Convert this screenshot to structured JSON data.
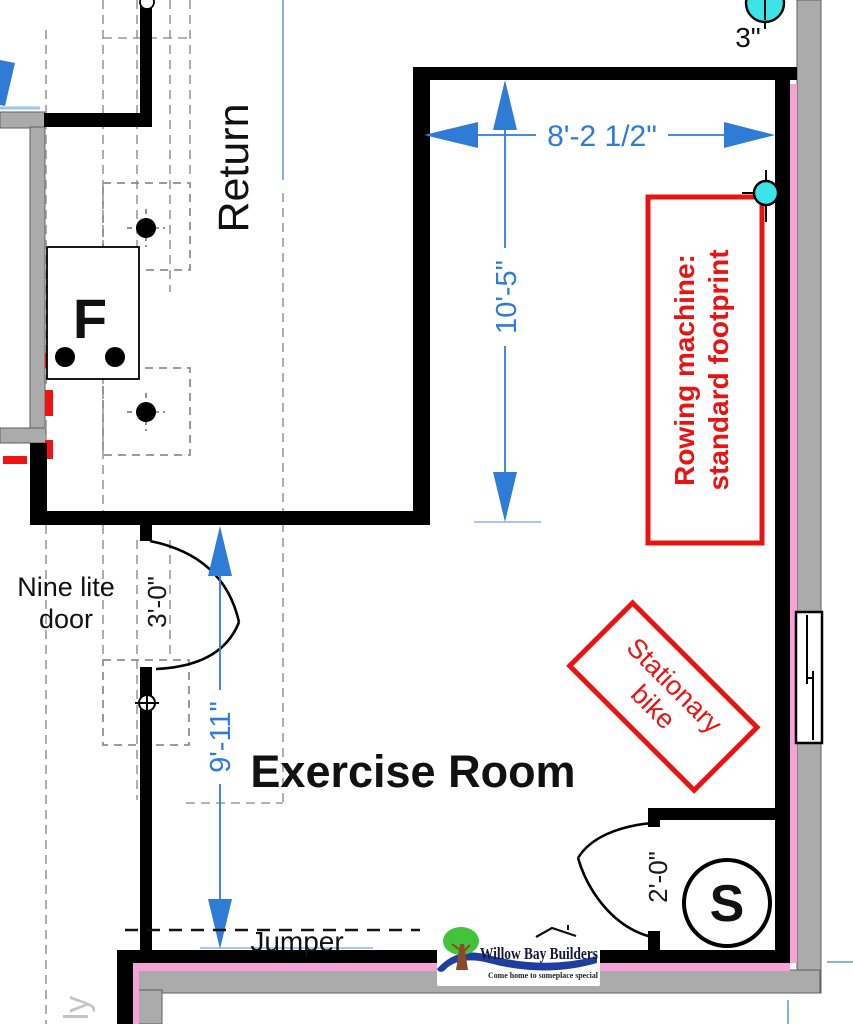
{
  "title": "Exercise Room floor plan",
  "labels": {
    "return_duct": "Return",
    "furnace": "F",
    "room_name": "Exercise Room",
    "door_note1": "Nine lite",
    "door_note2": "door",
    "jumper": "Jumper",
    "smoke_detector": "S",
    "partial_text": "ly"
  },
  "dims": {
    "top_width": "8'-2 1/2\"",
    "room_depth": "10'-5\"",
    "left_height": "9'-11\"",
    "door_width": "3'-0\"",
    "closet_door_width": "2'-0\"",
    "fixture_size": "3\""
  },
  "ann": {
    "rowing1": "Rowing machine:",
    "rowing2": "standard footprint",
    "bike1": "Stationary",
    "bike2": "bike"
  },
  "logo": {
    "name": "Willow Bay Builders",
    "tagline": "Come home to someplace special"
  },
  "colors": {
    "dimension_blue": "#2e7cd6",
    "extension_blue": "#8fb4e6",
    "annotation_red": "#e81414",
    "wall_gray": "#ababab",
    "insulation_pink": "#f5a3d7",
    "fixture_cyan": "#3ce4ea",
    "logo_blue": "#1e3f9e",
    "tree_green": "#42c339"
  }
}
